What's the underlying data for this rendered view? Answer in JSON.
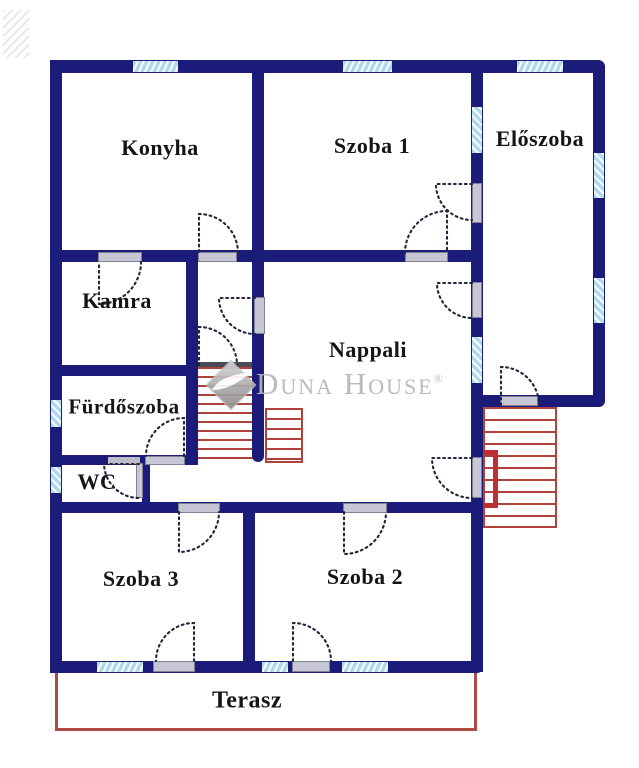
{
  "watermark": {
    "name": "Duna House",
    "registered": "®"
  },
  "rooms": {
    "konyha": "Konyha",
    "szoba1": "Szoba 1",
    "eloszoba": "Előszoba",
    "kamra": "Kamra",
    "nappali": "Nappali",
    "furdoszoba": "Fürdőszoba",
    "wc": "WC",
    "szoba3": "Szoba 3",
    "szoba2": "Szoba 2",
    "terasz": "Terasz"
  },
  "colors": {
    "wall": "#1b1b7a",
    "window": "#aed9ee",
    "stairs": "#b0413b",
    "terrace": "#b04a44",
    "leaf": "#c6c6d4",
    "arc": "#23233d",
    "watermark": "#b5b5b5",
    "label": "#151515"
  }
}
